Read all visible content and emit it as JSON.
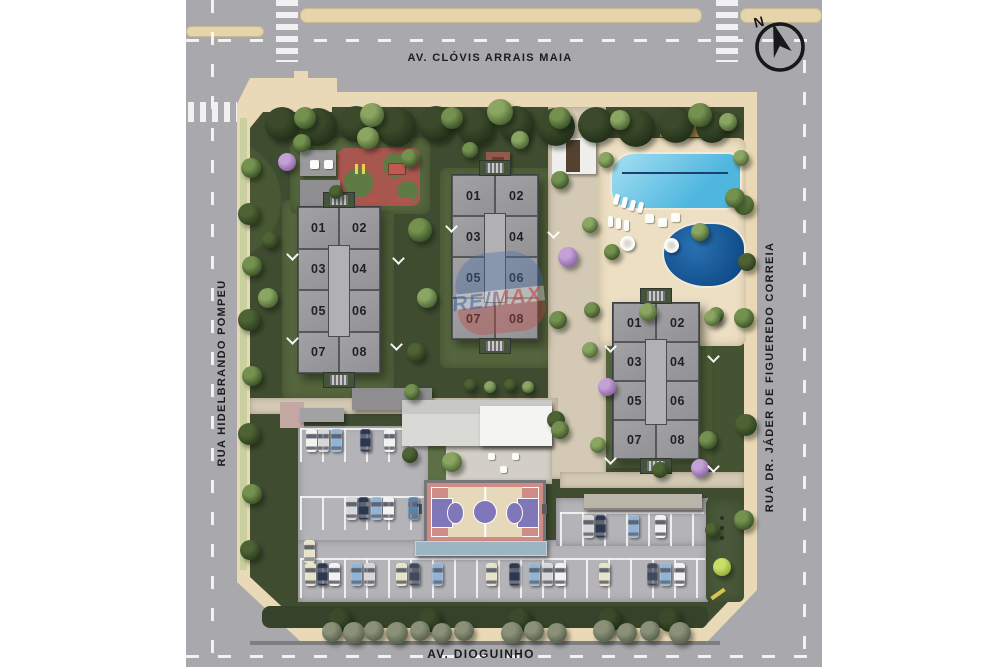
{
  "streets": {
    "top": "AV. CLÓVIS ARRAIS MAIA",
    "left": "RUA HIDELBRANDO POMPEU",
    "right": "RUA DR. JÁDER DE FIGUEREDO CORREIA",
    "bottom": "AV. DIOGUINHO"
  },
  "compass": {
    "label": "N"
  },
  "watermark": {
    "text": "RE/MAX"
  },
  "buildings": [
    {
      "id": "block-1",
      "units": [
        "01",
        "02",
        "03",
        "04",
        "05",
        "06",
        "07",
        "08"
      ]
    },
    {
      "id": "block-2",
      "units": [
        "01",
        "02",
        "03",
        "04",
        "05",
        "06",
        "07",
        "08"
      ]
    },
    {
      "id": "block-3",
      "units": [
        "01",
        "02",
        "03",
        "04",
        "05",
        "06",
        "07",
        "08"
      ]
    }
  ],
  "colors": {
    "road": "#a9a9ad",
    "sidewalk": "#e9d9b6",
    "green_dark": "#3f4c30",
    "building_grey": "#9a9a9d",
    "pool_light": "#4fb6de",
    "pool_dark": "#0f4a86",
    "court_pink": "#cf8b85",
    "court_purple": "#8077b8",
    "car_palette": {
      "W": "#f2f2f1",
      "S": "#d7d7da",
      "B": "#8fb4d8",
      "T": "#5b82a8",
      "N": "#2c3752",
      "D": "#41495e",
      "C": "#e9e3c6"
    },
    "tree_palette": {
      "a": [
        "#74914f",
        "#3a5026"
      ],
      "b": [
        "#8aa662",
        "#4a6132"
      ],
      "c": [
        "#4e6334",
        "#2c3d1d"
      ],
      "d": [
        "#8a9178",
        "#565e4a"
      ],
      "p": [
        "#c3a0d6",
        "#8a63a8"
      ],
      "l": [
        "#cadf6a",
        "#8fae3a"
      ],
      "k": [
        "#3a4a2a",
        "#222e18"
      ]
    }
  },
  "scene": {
    "cars": [
      [
        306,
        429,
        "W"
      ],
      [
        318,
        429,
        "S"
      ],
      [
        331,
        429,
        "B"
      ],
      [
        360,
        429,
        "N"
      ],
      [
        384,
        429,
        "W"
      ],
      [
        346,
        497,
        "S"
      ],
      [
        358,
        497,
        "N"
      ],
      [
        371,
        497,
        "B"
      ],
      [
        383,
        497,
        "W"
      ],
      [
        408,
        497,
        "T"
      ],
      [
        304,
        540,
        "C"
      ],
      [
        583,
        515,
        "S"
      ],
      [
        595,
        515,
        "N"
      ],
      [
        628,
        515,
        "B"
      ],
      [
        655,
        515,
        "W"
      ],
      [
        305,
        563,
        "C"
      ],
      [
        317,
        563,
        "N"
      ],
      [
        329,
        563,
        "W"
      ],
      [
        351,
        563,
        "B"
      ],
      [
        364,
        563,
        "S"
      ],
      [
        396,
        563,
        "C"
      ],
      [
        409,
        563,
        "D"
      ],
      [
        432,
        563,
        "B"
      ],
      [
        486,
        563,
        "C"
      ],
      [
        509,
        563,
        "N"
      ],
      [
        529,
        563,
        "B"
      ],
      [
        542,
        563,
        "S"
      ],
      [
        555,
        563,
        "W"
      ],
      [
        599,
        563,
        "C"
      ],
      [
        647,
        563,
        "D"
      ],
      [
        660,
        563,
        "B"
      ],
      [
        674,
        563,
        "W"
      ]
    ],
    "trees": [
      [
        282,
        124,
        17,
        "k"
      ],
      [
        318,
        127,
        19,
        "k"
      ],
      [
        356,
        124,
        18,
        "k"
      ],
      [
        396,
        127,
        20,
        "k"
      ],
      [
        436,
        124,
        18,
        "k"
      ],
      [
        476,
        127,
        19,
        "k"
      ],
      [
        516,
        124,
        18,
        "k"
      ],
      [
        556,
        127,
        19,
        "k"
      ],
      [
        596,
        125,
        18,
        "k"
      ],
      [
        636,
        128,
        19,
        "k"
      ],
      [
        676,
        125,
        18,
        "k"
      ],
      [
        712,
        127,
        16,
        "k"
      ],
      [
        305,
        118,
        11,
        "a"
      ],
      [
        372,
        115,
        12,
        "b"
      ],
      [
        452,
        118,
        11,
        "a"
      ],
      [
        500,
        112,
        13,
        "b"
      ],
      [
        560,
        118,
        11,
        "a"
      ],
      [
        620,
        120,
        10,
        "b"
      ],
      [
        700,
        115,
        12,
        "a"
      ],
      [
        728,
        122,
        9,
        "b"
      ],
      [
        251,
        168,
        10,
        "a"
      ],
      [
        249,
        214,
        11,
        "c"
      ],
      [
        252,
        266,
        10,
        "a"
      ],
      [
        249,
        320,
        11,
        "c"
      ],
      [
        252,
        376,
        10,
        "a"
      ],
      [
        249,
        434,
        11,
        "c"
      ],
      [
        252,
        494,
        10,
        "a"
      ],
      [
        250,
        550,
        10,
        "c"
      ],
      [
        744,
        205,
        10,
        "a"
      ],
      [
        747,
        262,
        9,
        "c"
      ],
      [
        744,
        318,
        10,
        "a"
      ],
      [
        746,
        425,
        11,
        "c"
      ],
      [
        744,
        520,
        10,
        "a"
      ],
      [
        340,
        620,
        12,
        "k"
      ],
      [
        430,
        620,
        12,
        "k"
      ],
      [
        520,
        620,
        12,
        "k"
      ],
      [
        610,
        620,
        12,
        "k"
      ],
      [
        670,
        620,
        12,
        "k"
      ],
      [
        332,
        632,
        10,
        "d"
      ],
      [
        354,
        633,
        11,
        "d"
      ],
      [
        374,
        631,
        10,
        "d"
      ],
      [
        397,
        633,
        11,
        "d"
      ],
      [
        420,
        631,
        10,
        "d"
      ],
      [
        442,
        633,
        10,
        "d"
      ],
      [
        464,
        631,
        10,
        "d"
      ],
      [
        512,
        633,
        11,
        "d"
      ],
      [
        534,
        631,
        10,
        "d"
      ],
      [
        557,
        633,
        10,
        "d"
      ],
      [
        604,
        631,
        11,
        "d"
      ],
      [
        627,
        633,
        10,
        "d"
      ],
      [
        650,
        631,
        10,
        "d"
      ],
      [
        680,
        633,
        11,
        "d"
      ],
      [
        420,
        230,
        12,
        "a"
      ],
      [
        427,
        298,
        10,
        "b"
      ],
      [
        416,
        352,
        9,
        "c"
      ],
      [
        412,
        392,
        8,
        "a"
      ],
      [
        268,
        298,
        10,
        "b"
      ],
      [
        270,
        240,
        8,
        "c"
      ],
      [
        302,
        143,
        9,
        "a"
      ],
      [
        368,
        138,
        11,
        "b"
      ],
      [
        410,
        158,
        9,
        "a"
      ],
      [
        336,
        192,
        7,
        "c"
      ],
      [
        287,
        162,
        9,
        "p"
      ],
      [
        568,
        257,
        10,
        "p"
      ],
      [
        607,
        387,
        9,
        "p"
      ],
      [
        700,
        468,
        9,
        "p"
      ],
      [
        606,
        160,
        8,
        "b"
      ],
      [
        735,
        198,
        10,
        "a"
      ],
      [
        700,
        232,
        9,
        "b"
      ],
      [
        612,
        252,
        8,
        "a"
      ],
      [
        741,
        158,
        8,
        "b"
      ],
      [
        648,
        312,
        9,
        "b"
      ],
      [
        716,
        315,
        8,
        "a"
      ],
      [
        560,
        180,
        9,
        "a"
      ],
      [
        590,
        225,
        8,
        "b"
      ],
      [
        558,
        320,
        9,
        "a"
      ],
      [
        590,
        350,
        8,
        "b"
      ],
      [
        556,
        420,
        9,
        "c"
      ],
      [
        592,
        310,
        8,
        "a"
      ],
      [
        712,
        318,
        8,
        "b"
      ],
      [
        598,
        445,
        8,
        "b"
      ],
      [
        708,
        440,
        9,
        "a"
      ],
      [
        660,
        470,
        8,
        "c"
      ],
      [
        452,
        462,
        10,
        "b"
      ],
      [
        560,
        430,
        9,
        "a"
      ],
      [
        410,
        455,
        8,
        "c"
      ],
      [
        722,
        567,
        9,
        "l"
      ],
      [
        712,
        530,
        7,
        "c"
      ],
      [
        470,
        150,
        8,
        "a"
      ],
      [
        520,
        140,
        9,
        "b"
      ],
      [
        470,
        385,
        6,
        "c"
      ],
      [
        490,
        387,
        6,
        "b"
      ],
      [
        510,
        385,
        6,
        "c"
      ],
      [
        528,
        387,
        6,
        "b"
      ]
    ],
    "marks": [
      [
        288,
        250
      ],
      [
        288,
        334
      ],
      [
        394,
        254
      ],
      [
        392,
        340
      ],
      [
        447,
        222
      ],
      [
        549,
        228
      ],
      [
        606,
        342
      ],
      [
        709,
        352
      ],
      [
        606,
        454
      ],
      [
        709,
        462
      ]
    ]
  }
}
